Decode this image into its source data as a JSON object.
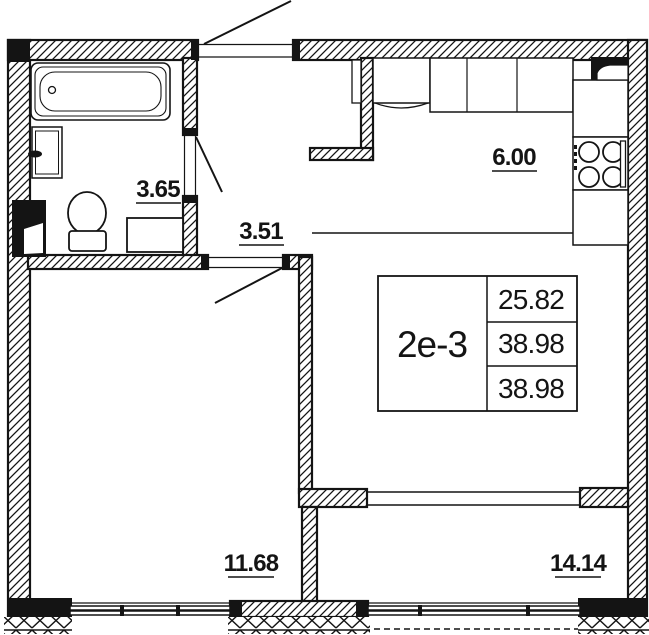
{
  "floor_plan": {
    "info_box": {
      "unit_label": "2е-3",
      "values": [
        "25.82",
        "38.98",
        "38.98"
      ]
    },
    "room_areas": {
      "bathroom": "3.65",
      "hallway": "3.51",
      "kitchen": "6.00",
      "bedroom": "11.68",
      "living_room": "14.14"
    },
    "colors": {
      "line": "#141414",
      "background": "#ffffff"
    }
  }
}
